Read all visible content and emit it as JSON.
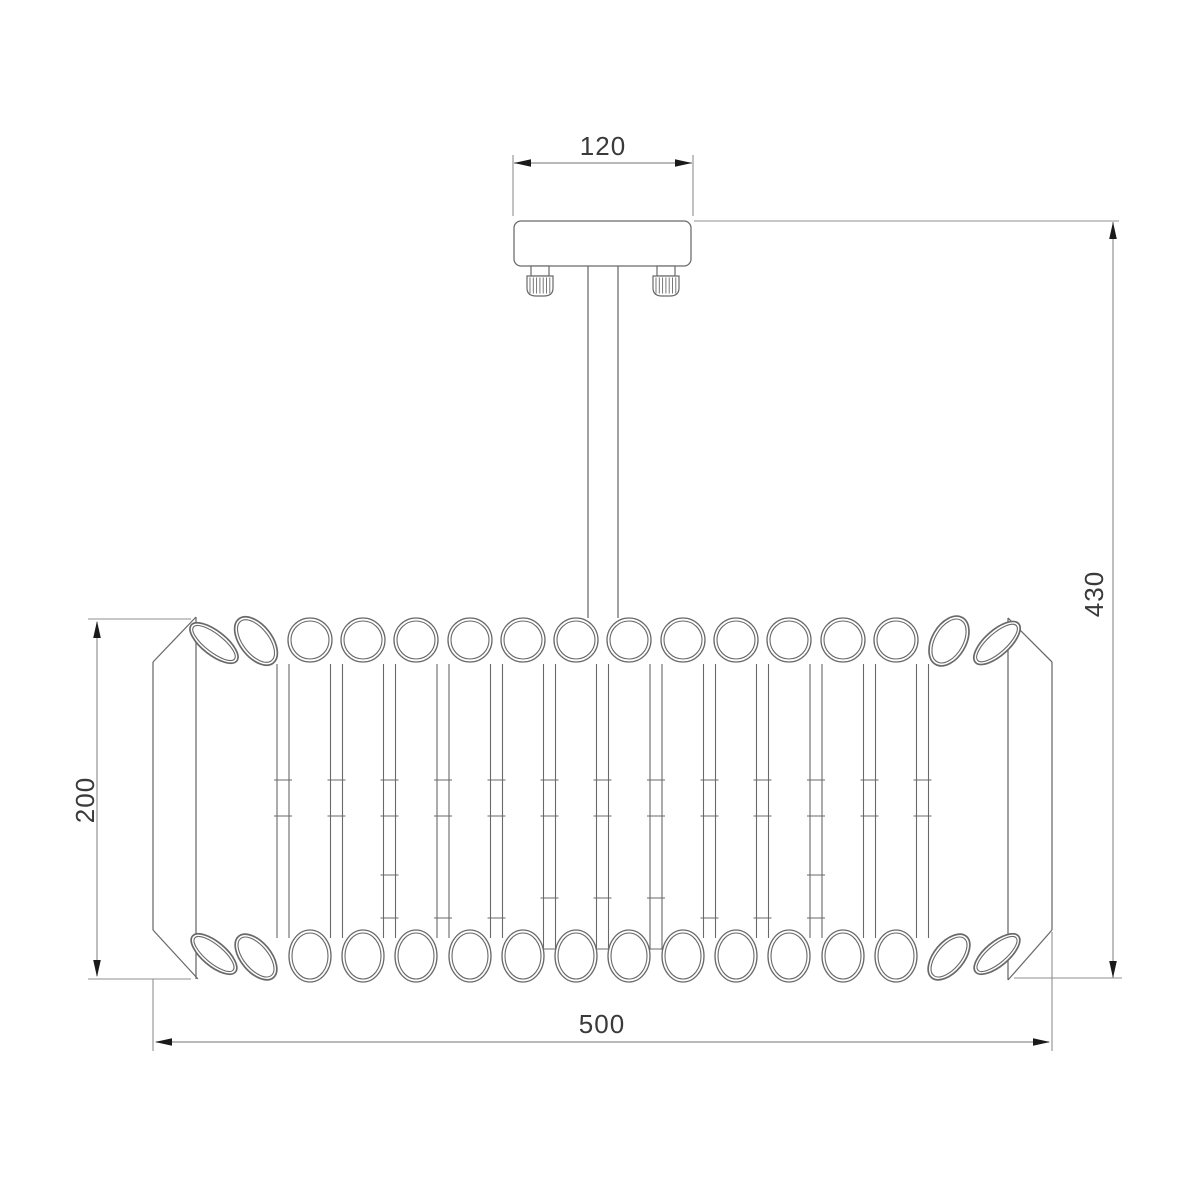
{
  "drawing": {
    "type": "technical-dimension-drawing",
    "subject": "semi-flush ceiling chandelier with crystal tube shade",
    "dimensions": {
      "canopy_width": "120",
      "overall_height": "430",
      "shade_height": "200",
      "shade_diameter": "500"
    },
    "shade": {
      "tube_count": 16,
      "junction_count": 13,
      "knob_count": 2
    },
    "colors": {
      "background": "#ffffff",
      "fixture_line": "#696969",
      "dim_line": "#8f8f8f",
      "arrow": "#1a1a1a",
      "text": "#3a3a3a"
    }
  }
}
